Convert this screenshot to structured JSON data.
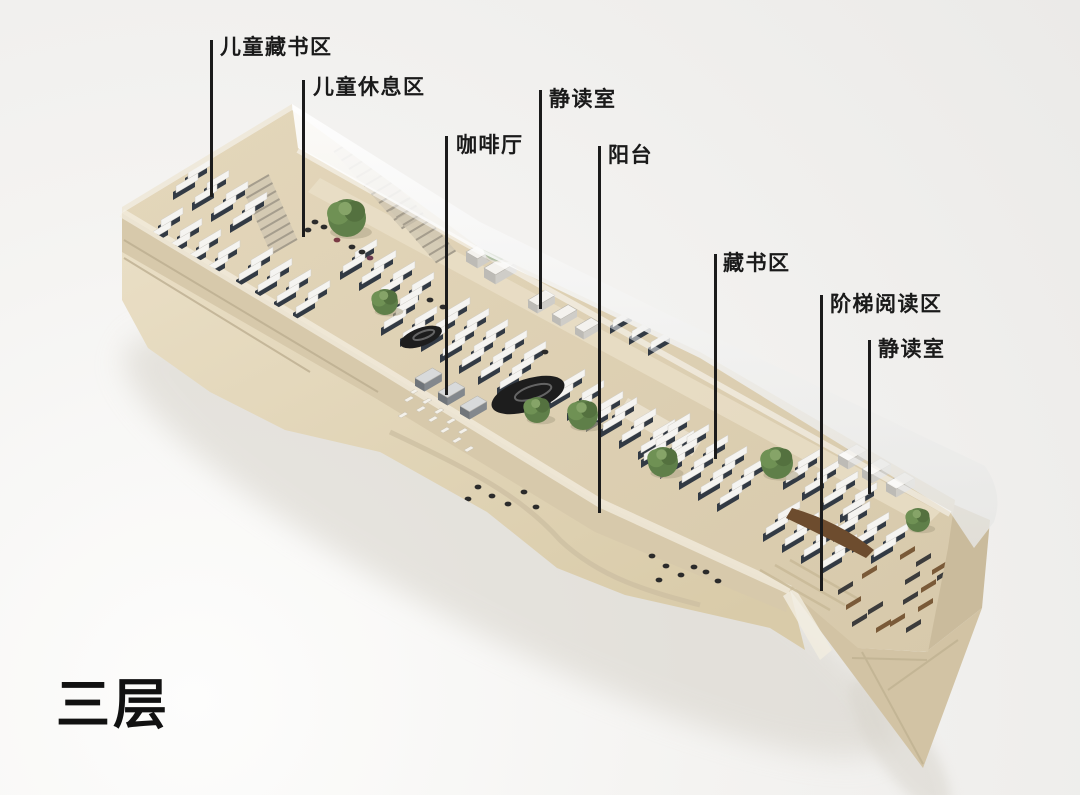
{
  "title": {
    "text": "三层",
    "meaning": "floor-3"
  },
  "palette": {
    "line-color": "#1b1b1b",
    "text-color": "#1a1a1a",
    "title-color": "#111111",
    "floor": "#ddd0b4",
    "terrace": "#e6dabf",
    "glass": "#f4f4f2",
    "shelf-dark": "#323a44",
    "shelf-light": "#f5f4f1",
    "tree-green": "#5f7f49",
    "canopy-black": "#1d1d1d",
    "wood-brown": "#7a5a38"
  },
  "callouts": [
    {
      "text": "儿童藏书区",
      "lx": 210,
      "y0": 40,
      "y1": 197,
      "tx": 220,
      "ty": 36
    },
    {
      "text": "儿童休息区",
      "lx": 302,
      "y0": 80,
      "y1": 237,
      "tx": 313,
      "ty": 76
    },
    {
      "text": "静读室",
      "lx": 539,
      "y0": 90,
      "y1": 309,
      "tx": 549,
      "ty": 88
    },
    {
      "text": "咖啡厅",
      "lx": 445,
      "y0": 136,
      "y1": 395,
      "tx": 456,
      "ty": 134
    },
    {
      "text": "阳台",
      "lx": 598,
      "y0": 146,
      "y1": 513,
      "tx": 608,
      "ty": 144
    },
    {
      "text": "藏书区",
      "lx": 714,
      "y0": 254,
      "y1": 459,
      "tx": 723,
      "ty": 252
    },
    {
      "text": "阶梯阅读区",
      "lx": 820,
      "y0": 295,
      "y1": 591,
      "tx": 830,
      "ty": 293
    },
    {
      "text": "静读室",
      "lx": 868,
      "y0": 340,
      "y1": 494,
      "tx": 878,
      "ty": 338
    }
  ],
  "scene": {
    "shelf_clusters": [
      {
        "x": 185,
        "y": 178,
        "c": 4,
        "r": 2
      },
      {
        "x": 158,
        "y": 226,
        "c": 4,
        "r": 2
      },
      {
        "x": 248,
        "y": 266,
        "c": 4,
        "r": 2
      },
      {
        "x": 210,
        "y": 300,
        "c": 3,
        "r": 1
      },
      {
        "x": 352,
        "y": 258,
        "c": 4,
        "r": 2
      },
      {
        "x": 445,
        "y": 316,
        "c": 5,
        "r": 3
      },
      {
        "x": 560,
        "y": 388,
        "c": 3,
        "r": 2
      },
      {
        "x": 612,
        "y": 416,
        "c": 4,
        "r": 2
      },
      {
        "x": 665,
        "y": 432,
        "c": 5,
        "r": 3
      },
      {
        "x": 795,
        "y": 468,
        "c": 4,
        "r": 2
      },
      {
        "x": 775,
        "y": 520,
        "c": 4,
        "r": 2
      },
      {
        "x": 436,
        "y": 178,
        "c": 2,
        "r": 1
      },
      {
        "x": 487,
        "y": 162,
        "c": 3,
        "r": 1
      },
      {
        "x": 610,
        "y": 326,
        "c": 3,
        "r": 1
      },
      {
        "x": 393,
        "y": 314,
        "c": 2,
        "r": 2
      },
      {
        "x": 845,
        "y": 520,
        "c": 3,
        "r": 2
      }
    ],
    "trees": [
      [
        347,
        218,
        19
      ],
      [
        385,
        302,
        13
      ],
      [
        497,
        247,
        14
      ],
      [
        537,
        410,
        13
      ],
      [
        583,
        415,
        15
      ],
      [
        663,
        462,
        15
      ],
      [
        777,
        463,
        16
      ],
      [
        918,
        520,
        12
      ]
    ],
    "stairs": [
      {
        "x": 243,
        "y": 190,
        "n": 8,
        "sx": 3.5,
        "sy": 8,
        "ex": 26,
        "ey": -15
      },
      {
        "x": 334,
        "y": 152,
        "n": 9,
        "sx": 7.5,
        "sy": 8.5,
        "ex": 22,
        "ey": -13
      },
      {
        "x": 390,
        "y": 210,
        "n": 7,
        "sx": 6.5,
        "sy": 7.5,
        "ex": 20,
        "ey": -12
      },
      {
        "x": 898,
        "y": 436,
        "n": 6,
        "sx": 6,
        "sy": 7,
        "ex": 20,
        "ey": -12
      }
    ],
    "boxes": [
      {
        "x": 466,
        "y": 252,
        "w": 34,
        "t": "light"
      },
      {
        "x": 484,
        "y": 268,
        "w": 34,
        "t": "light"
      },
      {
        "x": 528,
        "y": 300,
        "w": 28,
        "t": "light"
      },
      {
        "x": 552,
        "y": 314,
        "w": 26,
        "t": "light"
      },
      {
        "x": 575,
        "y": 327,
        "w": 26,
        "t": "light"
      },
      {
        "x": 415,
        "y": 378,
        "w": 28,
        "t": "gray"
      },
      {
        "x": 438,
        "y": 392,
        "w": 28,
        "t": "gray"
      },
      {
        "x": 460,
        "y": 406,
        "w": 28,
        "t": "gray"
      },
      {
        "x": 838,
        "y": 455,
        "w": 30,
        "t": "light"
      },
      {
        "x": 862,
        "y": 469,
        "w": 30,
        "t": "light"
      },
      {
        "x": 886,
        "y": 483,
        "w": 30,
        "t": "light"
      }
    ],
    "canopies": [
      {
        "cx": 528,
        "cy": 395,
        "rx": 38,
        "ry": 16,
        "rot": -18
      },
      {
        "cx": 421,
        "cy": 337,
        "rx": 22,
        "ry": 9,
        "rot": -20
      }
    ],
    "floor_figures": [
      [
        315,
        222
      ],
      [
        324,
        227
      ],
      [
        308,
        230
      ],
      [
        352,
        247
      ],
      [
        362,
        252
      ],
      [
        337,
        240,
        "#7a3b45"
      ],
      [
        370,
        258,
        "#6b3a50"
      ],
      [
        430,
        300
      ],
      [
        443,
        307
      ],
      [
        545,
        352
      ],
      [
        760,
        585
      ],
      [
        773,
        592
      ]
    ],
    "terrace_figures": [
      [
        478,
        487
      ],
      [
        492,
        496
      ],
      [
        508,
        504
      ],
      [
        468,
        499
      ],
      [
        524,
        492
      ],
      [
        536,
        507
      ],
      [
        652,
        556
      ],
      [
        666,
        566
      ],
      [
        681,
        575
      ],
      [
        694,
        567
      ],
      [
        659,
        580
      ],
      [
        706,
        572
      ],
      [
        718,
        581
      ]
    ],
    "chairs": [
      [
        404,
        400
      ],
      [
        416,
        410
      ],
      [
        428,
        420
      ],
      [
        440,
        431
      ],
      [
        452,
        441
      ],
      [
        410,
        392
      ],
      [
        422,
        402
      ],
      [
        434,
        412
      ],
      [
        398,
        416
      ],
      [
        464,
        450
      ],
      [
        446,
        422
      ],
      [
        458,
        432
      ]
    ],
    "tables": [
      [
        900,
        555,
        "w"
      ],
      [
        916,
        562,
        "d"
      ],
      [
        932,
        570,
        "w"
      ],
      [
        905,
        580,
        "d"
      ],
      [
        921,
        588,
        "w"
      ],
      [
        937,
        576,
        "d"
      ],
      [
        903,
        600,
        "d"
      ],
      [
        918,
        607,
        "w"
      ],
      [
        890,
        622,
        "w"
      ],
      [
        906,
        628,
        "d"
      ],
      [
        868,
        610,
        "d"
      ],
      [
        846,
        605,
        "w"
      ],
      [
        852,
        622,
        "d"
      ],
      [
        876,
        628,
        "w"
      ],
      [
        838,
        590,
        "d"
      ],
      [
        862,
        574,
        "w"
      ]
    ]
  }
}
